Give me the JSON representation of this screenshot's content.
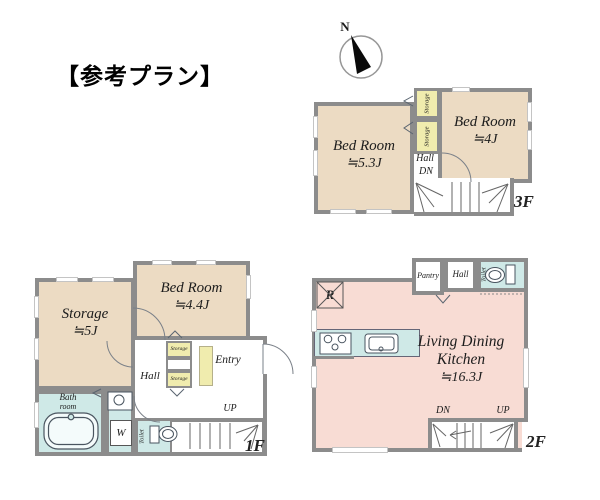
{
  "title": "【参考プラン】",
  "compass": {
    "north": "N"
  },
  "floor3": {
    "floor_label": "3F",
    "bedroom_left": {
      "name": "Bed Room",
      "size": "≒5.3J"
    },
    "bedroom_right": {
      "name": "Bed Room",
      "size": "≒4J"
    },
    "storage_upper": "Storage",
    "storage_lower": "Storage",
    "hall_label": "Hall",
    "dn_label": "DN"
  },
  "floor1": {
    "floor_label": "1F",
    "storage_room": {
      "name": "Storage",
      "size": "≒5J"
    },
    "bedroom": {
      "name": "Bed Room",
      "size": "≒4.4J"
    },
    "bathroom": {
      "line1": "Bath",
      "line2": "room"
    },
    "powder_room": {
      "line1": "Powder",
      "line2": "room"
    },
    "washer_label": "W",
    "toilet_label": "Toilet",
    "hall_label": "Hall",
    "closet_upper": "Storage",
    "closet_lower": "Storage",
    "entry_label": "Entry",
    "up_label": "UP"
  },
  "floor2": {
    "floor_label": "2F",
    "ldk": {
      "line1": "Living Dining",
      "line2": "Kitchen",
      "size": "≒16.3J"
    },
    "pantry_label": "Pantry",
    "hall_label": "Hall",
    "toilet_label": "Toilet",
    "fridge_label": "R",
    "dn_label": "DN",
    "up_label": "UP"
  },
  "colors": {
    "wall_gray": "#8c8c8c",
    "room_beige": "#ecdbc3",
    "closet_yellow": "#f0ecae",
    "wet_area_cyan": "#cfe9e7",
    "ldk_pink": "#f8dcd4"
  }
}
